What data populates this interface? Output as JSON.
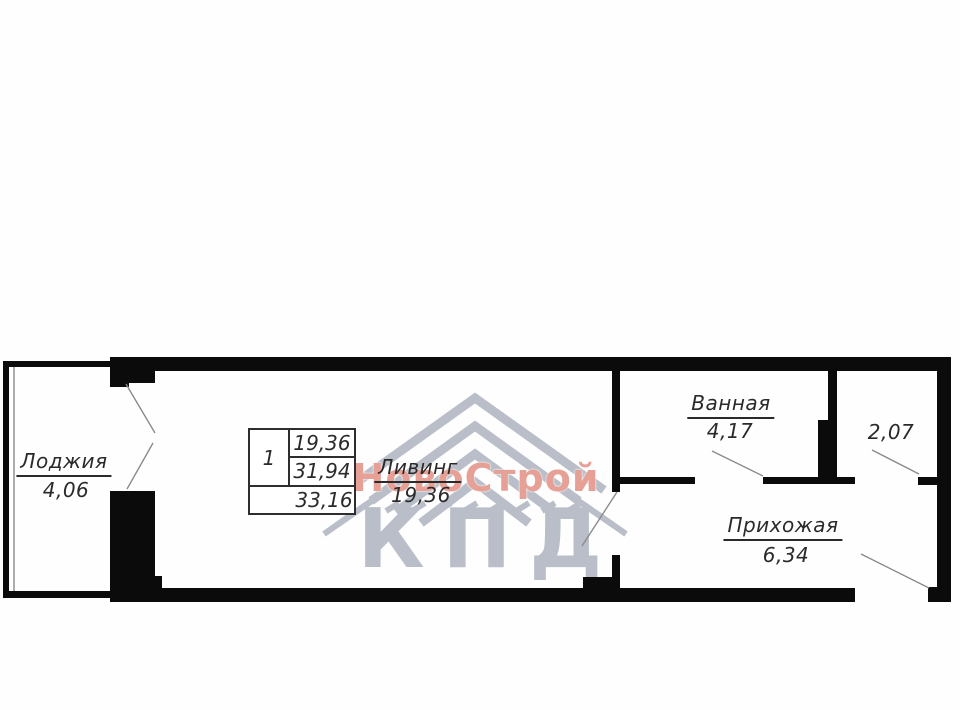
{
  "plan": {
    "rooms": [
      {
        "name": "Лоджия",
        "area": "4,06"
      },
      {
        "name": "Ливинг",
        "area": "19,36"
      },
      {
        "name": "Ванная",
        "area": "4,17"
      },
      {
        "name": "",
        "area": "2,07"
      },
      {
        "name": "Прихожая",
        "area": "6,34"
      }
    ],
    "stamp": {
      "rooms_count": "1",
      "living_area": "19,36",
      "apartment_area": "31,94",
      "total_area": "33,16"
    },
    "watermark": {
      "brand": "НовоСтрой",
      "logo": "КПД"
    },
    "colors": {
      "wall": "#0b0b0b",
      "thin_line": "#8b8b8b",
      "text": "#2a2a2a",
      "watermark_gray": "#b9bec8",
      "watermark_red": "#e6a096"
    }
  }
}
